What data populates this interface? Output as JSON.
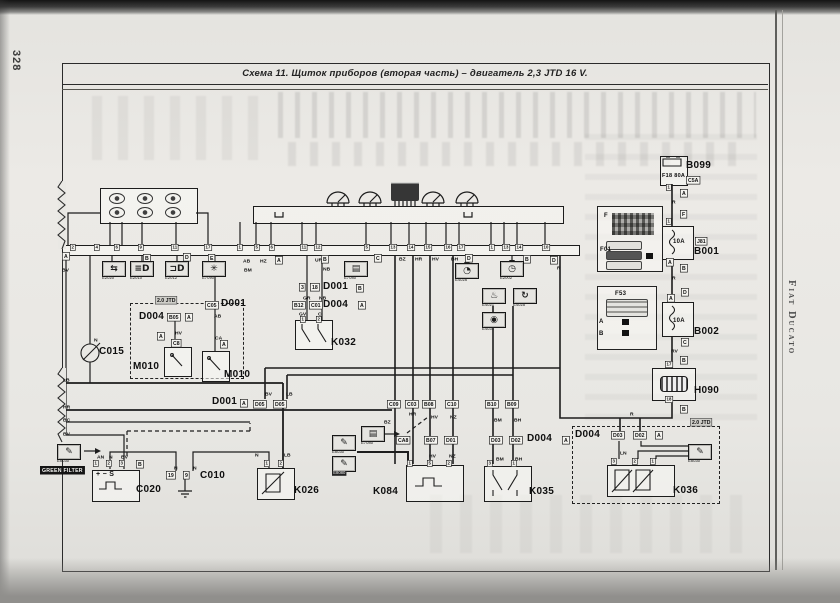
{
  "page": {
    "number": "328",
    "book_title": "Fiat Ducato"
  },
  "title": "Схема 11. Щиток приборов (вторая часть) – двигатель 2,3 JTD 16 V.",
  "diagram": {
    "green_filter_note": "GREEN FILTER",
    "tags": [
      {
        "t": "A",
        "x": 62,
        "y": 252
      },
      {
        "t": "B",
        "x": 143,
        "y": 254
      },
      {
        "t": "D",
        "x": 183,
        "y": 253
      },
      {
        "t": "E",
        "x": 208,
        "y": 254
      },
      {
        "t": "A",
        "x": 275,
        "y": 256
      },
      {
        "t": "B",
        "x": 321,
        "y": 255
      },
      {
        "t": "C",
        "x": 374,
        "y": 254
      },
      {
        "t": "D",
        "x": 465,
        "y": 254
      },
      {
        "t": "B",
        "x": 523,
        "y": 255
      },
      {
        "t": "D",
        "x": 550,
        "y": 256
      },
      {
        "t": "A",
        "x": 680,
        "y": 189
      },
      {
        "t": "F",
        "x": 680,
        "y": 210
      },
      {
        "t": "A",
        "x": 666,
        "y": 258
      },
      {
        "t": "B",
        "x": 680,
        "y": 264
      },
      {
        "t": "D",
        "x": 681,
        "y": 288
      },
      {
        "t": "A",
        "x": 667,
        "y": 294
      },
      {
        "t": "C",
        "x": 681,
        "y": 338
      },
      {
        "t": "B",
        "x": 680,
        "y": 356
      },
      {
        "t": "B",
        "x": 680,
        "y": 405
      },
      {
        "t": "B",
        "x": 136,
        "y": 460
      },
      {
        "t": "C05",
        "x": 205,
        "y": 301
      },
      {
        "t": "B05",
        "x": 167,
        "y": 313
      },
      {
        "t": "A",
        "x": 185,
        "y": 313
      },
      {
        "t": "A",
        "x": 157,
        "y": 332
      },
      {
        "t": "C8",
        "x": 171,
        "y": 339
      },
      {
        "t": "A",
        "x": 220,
        "y": 340
      },
      {
        "t": "3",
        "x": 299,
        "y": 283
      },
      {
        "t": "18",
        "x": 310,
        "y": 283
      },
      {
        "t": "B",
        "x": 356,
        "y": 284
      },
      {
        "t": "B12",
        "x": 292,
        "y": 301
      },
      {
        "t": "C01",
        "x": 309,
        "y": 301
      },
      {
        "t": "A",
        "x": 358,
        "y": 301
      },
      {
        "t": "A",
        "x": 240,
        "y": 399
      },
      {
        "t": "D05",
        "x": 253,
        "y": 400
      },
      {
        "t": "D05",
        "x": 273,
        "y": 400
      },
      {
        "t": "C09",
        "x": 387,
        "y": 400
      },
      {
        "t": "C03",
        "x": 405,
        "y": 400
      },
      {
        "t": "B08",
        "x": 422,
        "y": 400
      },
      {
        "t": "C10",
        "x": 445,
        "y": 400
      },
      {
        "t": "B10",
        "x": 485,
        "y": 400
      },
      {
        "t": "B09",
        "x": 505,
        "y": 400
      },
      {
        "t": "CA8",
        "x": 396,
        "y": 436
      },
      {
        "t": "B07",
        "x": 424,
        "y": 436
      },
      {
        "t": "D01",
        "x": 444,
        "y": 436
      },
      {
        "t": "D03",
        "x": 489,
        "y": 436
      },
      {
        "t": "D02",
        "x": 509,
        "y": 436
      },
      {
        "t": "A",
        "x": 562,
        "y": 436
      },
      {
        "t": "D03",
        "x": 611,
        "y": 431
      },
      {
        "t": "D02",
        "x": 633,
        "y": 431
      },
      {
        "t": "A",
        "x": 655,
        "y": 431
      },
      {
        "t": "J81",
        "x": 695,
        "y": 237
      },
      {
        "t": "C5A",
        "x": 686,
        "y": 176
      },
      {
        "t": "19",
        "x": 166,
        "y": 471
      },
      {
        "t": "9",
        "x": 183,
        "y": 471
      },
      {
        "t": "2.0 JTD",
        "x": 155,
        "y": 296,
        "cls": "gray"
      },
      {
        "t": "2.0 JTD",
        "x": 690,
        "y": 418,
        "cls": "gray"
      }
    ],
    "pins": [
      {
        "t": "2",
        "x": 70,
        "y": 244
      },
      {
        "t": "4",
        "x": 94,
        "y": 244
      },
      {
        "t": "6",
        "x": 114,
        "y": 244
      },
      {
        "t": "9",
        "x": 138,
        "y": 244
      },
      {
        "t": "11",
        "x": 171,
        "y": 244
      },
      {
        "t": "17",
        "x": 204,
        "y": 244
      },
      {
        "t": "1",
        "x": 237,
        "y": 244
      },
      {
        "t": "5",
        "x": 254,
        "y": 244
      },
      {
        "t": "6",
        "x": 269,
        "y": 244
      },
      {
        "t": "11",
        "x": 300,
        "y": 244
      },
      {
        "t": "12",
        "x": 314,
        "y": 244
      },
      {
        "t": "5",
        "x": 364,
        "y": 244
      },
      {
        "t": "13",
        "x": 389,
        "y": 244
      },
      {
        "t": "14",
        "x": 407,
        "y": 244
      },
      {
        "t": "15",
        "x": 424,
        "y": 244
      },
      {
        "t": "16",
        "x": 444,
        "y": 244
      },
      {
        "t": "17",
        "x": 457,
        "y": 244
      },
      {
        "t": "1",
        "x": 489,
        "y": 244
      },
      {
        "t": "13",
        "x": 502,
        "y": 244
      },
      {
        "t": "14",
        "x": 515,
        "y": 244
      },
      {
        "t": "10",
        "x": 542,
        "y": 244
      },
      {
        "t": "1",
        "x": 300,
        "y": 316
      },
      {
        "t": "2",
        "x": 316,
        "y": 316
      },
      {
        "t": "1",
        "x": 93,
        "y": 460
      },
      {
        "t": "2",
        "x": 106,
        "y": 460
      },
      {
        "t": "3",
        "x": 119,
        "y": 460
      },
      {
        "t": "1",
        "x": 264,
        "y": 460
      },
      {
        "t": "2",
        "x": 278,
        "y": 460
      },
      {
        "t": "1",
        "x": 407,
        "y": 460
      },
      {
        "t": "5",
        "x": 427,
        "y": 460
      },
      {
        "t": "2",
        "x": 446,
        "y": 460
      },
      {
        "t": "3",
        "x": 487,
        "y": 460
      },
      {
        "t": "1",
        "x": 511,
        "y": 460
      },
      {
        "t": "3",
        "x": 611,
        "y": 458
      },
      {
        "t": "2",
        "x": 632,
        "y": 458
      },
      {
        "t": "1",
        "x": 650,
        "y": 458
      },
      {
        "t": "1",
        "x": 666,
        "y": 184
      },
      {
        "t": "1",
        "x": 666,
        "y": 218
      },
      {
        "t": "17",
        "x": 665,
        "y": 361
      },
      {
        "t": "18",
        "x": 665,
        "y": 396
      }
    ],
    "wire_labels": [
      {
        "t": "BV",
        "x": 62,
        "y": 267
      },
      {
        "t": "AB",
        "x": 243,
        "y": 258
      },
      {
        "t": "HZ",
        "x": 260,
        "y": 258
      },
      {
        "t": "BM",
        "x": 244,
        "y": 267
      },
      {
        "t": "UR",
        "x": 315,
        "y": 257
      },
      {
        "t": "NB",
        "x": 323,
        "y": 266
      },
      {
        "t": "GR",
        "x": 303,
        "y": 295
      },
      {
        "t": "NB",
        "x": 319,
        "y": 295
      },
      {
        "t": "GV",
        "x": 299,
        "y": 311
      },
      {
        "t": "C",
        "x": 318,
        "y": 311
      },
      {
        "t": "BZ",
        "x": 399,
        "y": 256
      },
      {
        "t": "HR",
        "x": 415,
        "y": 256
      },
      {
        "t": "HV",
        "x": 432,
        "y": 256
      },
      {
        "t": "BH",
        "x": 451,
        "y": 256
      },
      {
        "t": "R",
        "x": 557,
        "y": 265
      },
      {
        "t": "HV",
        "x": 175,
        "y": 330
      },
      {
        "t": "AB",
        "x": 214,
        "y": 313
      },
      {
        "t": "CA",
        "x": 215,
        "y": 335
      },
      {
        "t": "N",
        "x": 94,
        "y": 337
      },
      {
        "t": "LB",
        "x": 63,
        "y": 377
      },
      {
        "t": "HR",
        "x": 63,
        "y": 404
      },
      {
        "t": "BC",
        "x": 63,
        "y": 417
      },
      {
        "t": "BV",
        "x": 63,
        "y": 431
      },
      {
        "t": "BV",
        "x": 265,
        "y": 391
      },
      {
        "t": "LB",
        "x": 286,
        "y": 391
      },
      {
        "t": "BZ",
        "x": 384,
        "y": 419
      },
      {
        "t": "HR",
        "x": 409,
        "y": 411
      },
      {
        "t": "HV",
        "x": 431,
        "y": 414
      },
      {
        "t": "NZ",
        "x": 450,
        "y": 414
      },
      {
        "t": "BM",
        "x": 494,
        "y": 417
      },
      {
        "t": "BH",
        "x": 514,
        "y": 417
      },
      {
        "t": "HV",
        "x": 429,
        "y": 453
      },
      {
        "t": "NZ",
        "x": 449,
        "y": 453
      },
      {
        "t": "BM",
        "x": 496,
        "y": 456
      },
      {
        "t": "BH",
        "x": 515,
        "y": 456
      },
      {
        "t": "N",
        "x": 255,
        "y": 452
      },
      {
        "t": "LB",
        "x": 284,
        "y": 452
      },
      {
        "t": "AN",
        "x": 97,
        "y": 454
      },
      {
        "t": "N",
        "x": 109,
        "y": 454
      },
      {
        "t": "BV",
        "x": 121,
        "y": 454
      },
      {
        "t": "N",
        "x": 174,
        "y": 465
      },
      {
        "t": "N",
        "x": 193,
        "y": 465
      },
      {
        "t": "LN",
        "x": 620,
        "y": 450
      },
      {
        "t": "R",
        "x": 672,
        "y": 199
      },
      {
        "t": "R",
        "x": 672,
        "y": 275
      },
      {
        "t": "RV",
        "x": 671,
        "y": 348
      },
      {
        "t": "R",
        "x": 630,
        "y": 411
      }
    ],
    "component_labels": [
      {
        "t": "B099",
        "x": 686,
        "y": 160
      },
      {
        "t": "B001",
        "x": 694,
        "y": 246
      },
      {
        "t": "B002",
        "x": 694,
        "y": 326
      },
      {
        "t": "H090",
        "x": 694,
        "y": 385
      },
      {
        "t": "C015",
        "x": 99,
        "y": 346
      },
      {
        "t": "M010",
        "x": 133,
        "y": 361
      },
      {
        "t": "M010",
        "x": 224,
        "y": 369
      },
      {
        "t": "D004",
        "x": 139,
        "y": 311
      },
      {
        "t": "D001",
        "x": 221,
        "y": 298
      },
      {
        "t": "D001",
        "x": 323,
        "y": 281
      },
      {
        "t": "D004",
        "x": 323,
        "y": 299
      },
      {
        "t": "K032",
        "x": 331,
        "y": 337
      },
      {
        "t": "D001",
        "x": 212,
        "y": 396
      },
      {
        "t": "C020",
        "x": 136,
        "y": 484
      },
      {
        "t": "C010",
        "x": 200,
        "y": 470
      },
      {
        "t": "K026",
        "x": 294,
        "y": 485
      },
      {
        "t": "K084",
        "x": 373,
        "y": 486
      },
      {
        "t": "K035",
        "x": 529,
        "y": 486
      },
      {
        "t": "D004",
        "x": 527,
        "y": 433
      },
      {
        "t": "D004",
        "x": 575,
        "y": 429
      },
      {
        "t": "K036",
        "x": 673,
        "y": 485
      },
      {
        "t": "F",
        "x": 604,
        "y": 211,
        "fs": 6
      },
      {
        "t": "F01",
        "x": 600,
        "y": 245,
        "fs": 6
      },
      {
        "t": "F53",
        "x": 615,
        "y": 289,
        "fs": 6
      },
      {
        "t": "A",
        "x": 599,
        "y": 317,
        "fs": 6
      },
      {
        "t": "B",
        "x": 599,
        "y": 329,
        "fs": 6
      },
      {
        "t": "F18 80A",
        "x": 662,
        "y": 171,
        "fs": 5.5
      },
      {
        "t": "10A",
        "x": 673,
        "y": 237,
        "fs": 6
      },
      {
        "t": "10A",
        "x": 673,
        "y": 316,
        "fs": 6
      },
      {
        "t": "+  −  S",
        "x": 96,
        "y": 469,
        "fs": 7
      }
    ],
    "icons": [
      {
        "t": "E2020",
        "g": "⇆",
        "x": 102,
        "y": 261,
        "n": "turn-indicator-icon"
      },
      {
        "t": "E2010",
        "g": "≡D",
        "x": 130,
        "y": 261,
        "n": "high-beam-icon"
      },
      {
        "t": "E2012",
        "g": "⊐D",
        "x": 165,
        "y": 261,
        "n": "headlamp-icon"
      },
      {
        "t": "E7090",
        "g": "✳",
        "x": 202,
        "y": 261,
        "n": "heater-fan-icon"
      },
      {
        "t": "E7080",
        "g": "▤",
        "x": 344,
        "y": 261,
        "n": "display-icon"
      },
      {
        "t": "E4026",
        "g": "◔",
        "x": 455,
        "y": 263,
        "n": "fuel-level-icon"
      },
      {
        "t": "E2002",
        "g": "◷",
        "x": 500,
        "y": 261,
        "n": "instrument-icon"
      },
      {
        "t": "E4021",
        "g": "♨",
        "x": 482,
        "y": 288,
        "n": "temp-warning-icon"
      },
      {
        "t": "E4025",
        "g": "↻",
        "x": 513,
        "y": 288,
        "n": "rev-counter-icon"
      },
      {
        "t": "E4031",
        "g": "◉",
        "x": 482,
        "y": 312,
        "n": "speaker-icon"
      },
      {
        "t": "E8030",
        "g": "✎",
        "x": 57,
        "y": 444,
        "n": "diagnostic-tool-icon"
      },
      {
        "t": "E7080",
        "g": "▤",
        "x": 361,
        "y": 426,
        "n": "display-icon"
      },
      {
        "t": "E8030",
        "g": "✎",
        "x": 332,
        "y": 435,
        "n": "diagnostic-tool-icon"
      },
      {
        "t": "E8080",
        "g": "✎",
        "x": 332,
        "y": 456,
        "hl": 1,
        "n": "diagnostic-tool-icon"
      },
      {
        "t": "E8030",
        "g": "✎",
        "x": 688,
        "y": 444,
        "n": "diagnostic-tool-icon"
      }
    ]
  }
}
